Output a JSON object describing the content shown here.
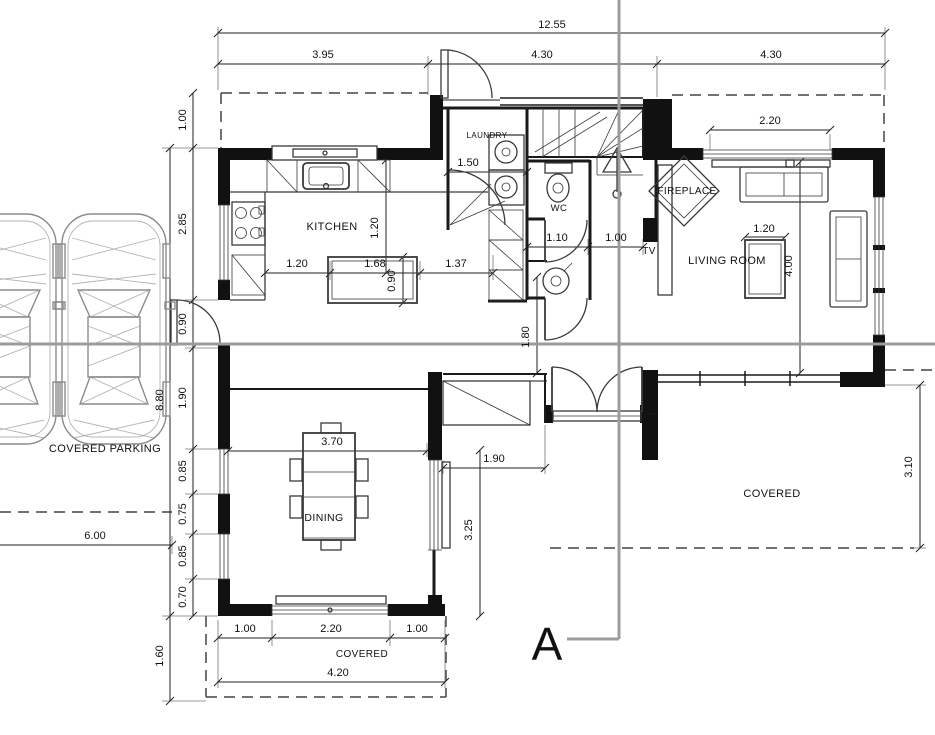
{
  "plan": {
    "rooms": {
      "kitchen": "KITCHEN",
      "laundry": "LAUNDRY",
      "wc": "WC",
      "living_room": "LIVING ROOM",
      "dining": "DINING",
      "fireplace": "FIREPLACE",
      "tv": "TV",
      "covered_parking": "COVERED PARKING",
      "covered_terrace": "COVERED",
      "covered_porch": "COVERED"
    },
    "section_marker": "A",
    "dims": {
      "top_overall": "12.55",
      "top_seg1": "3.95",
      "top_seg2": "4.30",
      "top_seg3": "4.30",
      "living_window": "2.20",
      "left_1": "1.00",
      "left_2": "2.85",
      "left_3": "0.90",
      "left_4": "1.90",
      "left_5": "0.85",
      "left_6": "0.75",
      "left_7": "0.85",
      "left_8": "0.70",
      "left_overall": "8.80",
      "left_porch": "1.60",
      "parking_width": "6.00",
      "kitchen_row_1": "1.20",
      "kitchen_row_2": "1.68",
      "kitchen_row_3": "1.37",
      "kitchen_vert": "1.20",
      "island_depth": "0.90",
      "laundry_width": "1.50",
      "wc_width": "1.10",
      "hall_width": "1.00",
      "hall_vert": "1.80",
      "recess_width": "1.90",
      "dining_depth": "3.25",
      "dining_table": "3.70",
      "bottom_1": "1.00",
      "bottom_2": "2.20",
      "bottom_3": "1.00",
      "bottom_overall": "4.20",
      "terrace_depth": "3.10",
      "living_depth": "4.00",
      "coffee_table": "1.20"
    },
    "colors": {
      "wall": "#111111",
      "line": "#222222",
      "dim_text": "#1a1a1a",
      "section_line": "#9c9c9c",
      "car": "#8b8b8b"
    }
  }
}
